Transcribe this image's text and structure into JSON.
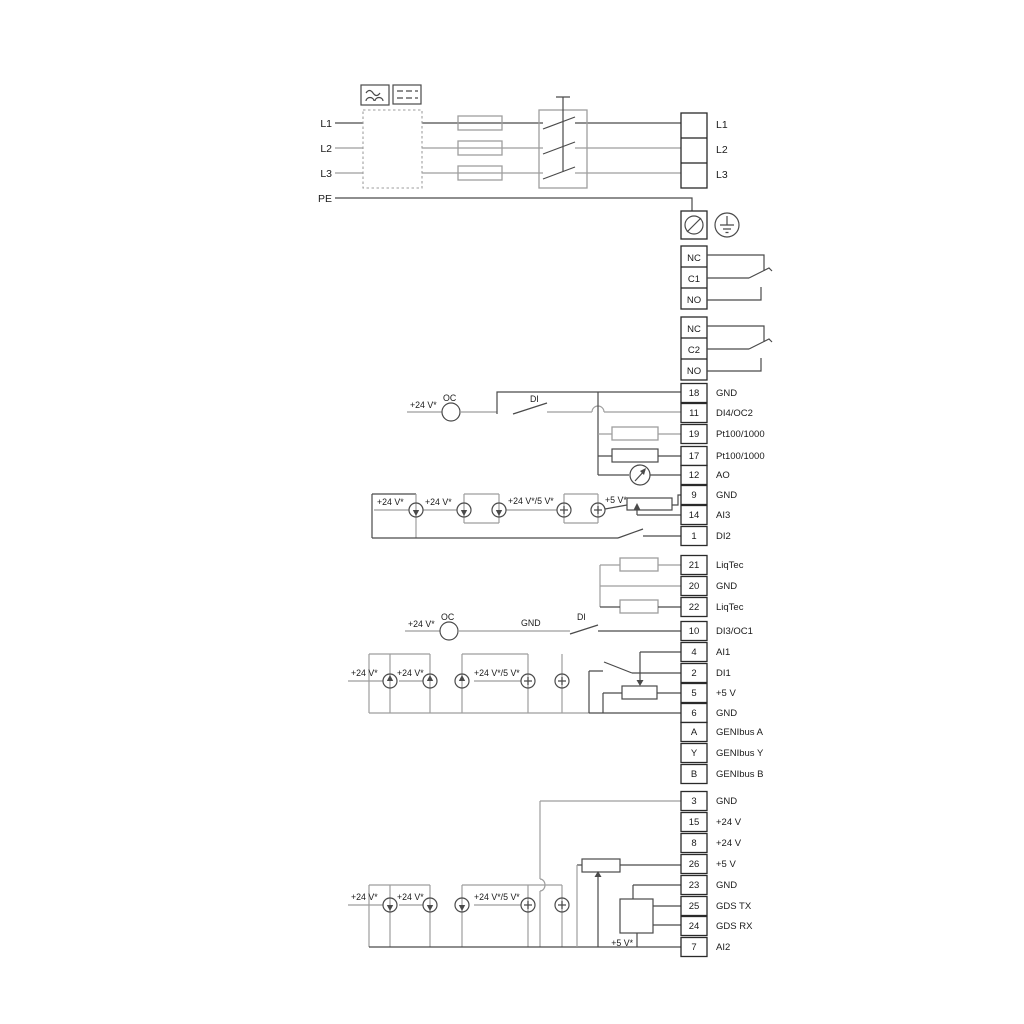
{
  "power": {
    "inputs": [
      "L1",
      "L2",
      "L3",
      "PE"
    ],
    "outputs": [
      "L1",
      "L2",
      "L3"
    ]
  },
  "relays": [
    {
      "rows": [
        "NC",
        "C1",
        "NO"
      ]
    },
    {
      "rows": [
        "NC",
        "C2",
        "NO"
      ]
    }
  ],
  "groups": {
    "io1": [
      {
        "num": "18",
        "label": "GND"
      },
      {
        "num": "11",
        "label": "DI4/OC2"
      },
      {
        "num": "19",
        "label": "Pt100/1000"
      },
      {
        "num": "17",
        "label": "Pt100/1000"
      },
      {
        "num": "12",
        "label": "AO"
      },
      {
        "num": "9",
        "label": "GND"
      },
      {
        "num": "14",
        "label": "AI3"
      },
      {
        "num": "1",
        "label": "DI2"
      }
    ],
    "io2": [
      {
        "num": "21",
        "label": "LiqTec"
      },
      {
        "num": "20",
        "label": "GND"
      },
      {
        "num": "22",
        "label": "LiqTec"
      }
    ],
    "io3": [
      {
        "num": "10",
        "label": "DI3/OC1"
      },
      {
        "num": "4",
        "label": "AI1"
      },
      {
        "num": "2",
        "label": "DI1"
      },
      {
        "num": "5",
        "label": "+5 V"
      },
      {
        "num": "6",
        "label": "GND"
      },
      {
        "num": "A",
        "label": "GENIbus A"
      },
      {
        "num": "Y",
        "label": "GENIbus Y"
      },
      {
        "num": "B",
        "label": "GENIbus B"
      }
    ],
    "io4": [
      {
        "num": "3",
        "label": "GND"
      },
      {
        "num": "15",
        "label": "+24 V"
      },
      {
        "num": "8",
        "label": "+24 V"
      },
      {
        "num": "26",
        "label": "+5 V"
      },
      {
        "num": "23",
        "label": "GND"
      },
      {
        "num": "25",
        "label": "GDS TX"
      },
      {
        "num": "24",
        "label": "GDS RX"
      },
      {
        "num": "7",
        "label": "AI2"
      }
    ]
  },
  "ann": {
    "plus24": "+24 V*",
    "oc": "OC",
    "di": "DI",
    "gnd": "GND",
    "plus24or5": "+24 V*/5 V*",
    "plus5": "+5 V*"
  },
  "colors": {
    "wire_gray": "#9e9e9e",
    "wire_dark": "#4a4a4a",
    "text": "#1a1a1a"
  }
}
